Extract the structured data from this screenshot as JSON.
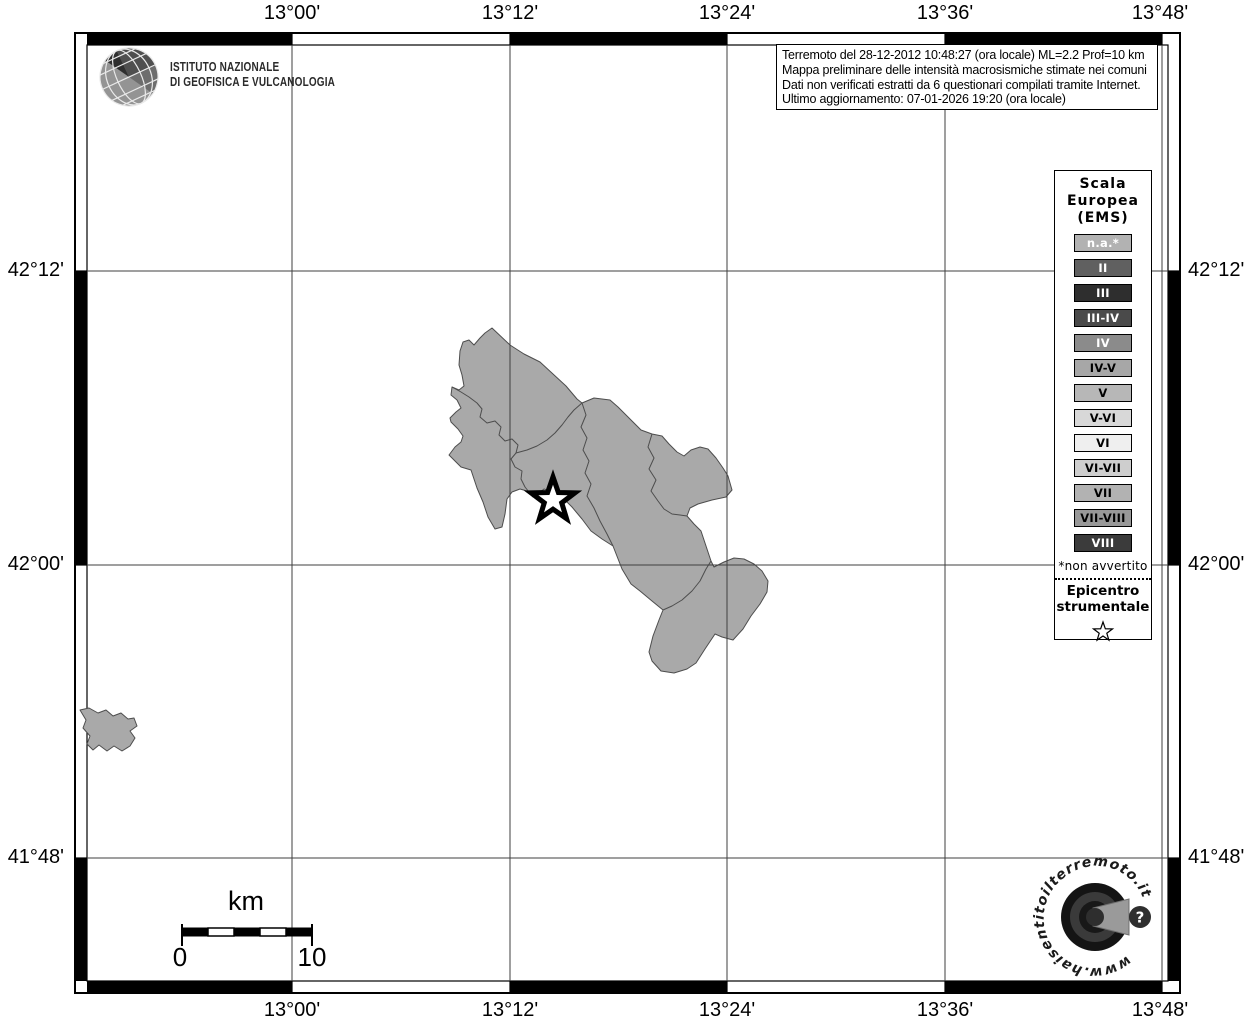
{
  "axes": {
    "x": [
      "13°00'",
      "13°12'",
      "13°24'",
      "13°36'",
      "13°48'"
    ],
    "y": [
      "42°12'",
      "42°00'",
      "41°48'"
    ]
  },
  "header": {
    "ingv_line1": "ISTITUTO NAZIONALE",
    "ingv_line2": "DI GEOFISICA E VULCANOLOGIA"
  },
  "info_box": {
    "lines": [
      "Terremoto del 28-12-2012 10:48:27 (ora locale) ML=2.2 Prof=10 km",
      "Mappa preliminare delle intensità macrosismiche stimate nei comuni",
      "Dati non verificati estratti da 6 questionari compilati tramite Internet.",
      "Ultimo aggiornamento: 07-01-2026 19:20 (ora locale)"
    ]
  },
  "legend": {
    "title_lines": [
      "Scala",
      "Europea",
      "(EMS)"
    ],
    "items": [
      {
        "label": "n.a.*",
        "bg": "#b2b2b2",
        "fg": "#ffffff"
      },
      {
        "label": "II",
        "bg": "#606060",
        "fg": "#ffffff"
      },
      {
        "label": "III",
        "bg": "#2e2e2e",
        "fg": "#ffffff"
      },
      {
        "label": "III-IV",
        "bg": "#4a4a4a",
        "fg": "#ffffff"
      },
      {
        "label": "IV",
        "bg": "#8b8b8b",
        "fg": "#ffffff"
      },
      {
        "label": "IV-V",
        "bg": "#a7a7a7",
        "fg": "#000000"
      },
      {
        "label": "V",
        "bg": "#b7b7b7",
        "fg": "#000000"
      },
      {
        "label": "V-VI",
        "bg": "#d8d8d8",
        "fg": "#000000"
      },
      {
        "label": "VI",
        "bg": "#efefef",
        "fg": "#000000"
      },
      {
        "label": "VI-VII",
        "bg": "#cecece",
        "fg": "#000000"
      },
      {
        "label": "VII",
        "bg": "#b2b2b2",
        "fg": "#000000"
      },
      {
        "label": "VII-VIII",
        "bg": "#989898",
        "fg": "#000000"
      },
      {
        "label": "VIII",
        "bg": "#3b3b3b",
        "fg": "#ffffff"
      }
    ],
    "footnote": "*non avvertito",
    "epicenter_line1": "Epicentro",
    "epicenter_line2": "strumentale"
  },
  "scale_bar": {
    "unit": "km",
    "min": "0",
    "max": "10"
  },
  "watermark": {
    "circular_text": "www.haisentitoilterremoto.it",
    "question_mark": "?"
  },
  "map": {
    "region_fill": "#a9a9a9",
    "region_stroke": "#4d4d4d"
  }
}
